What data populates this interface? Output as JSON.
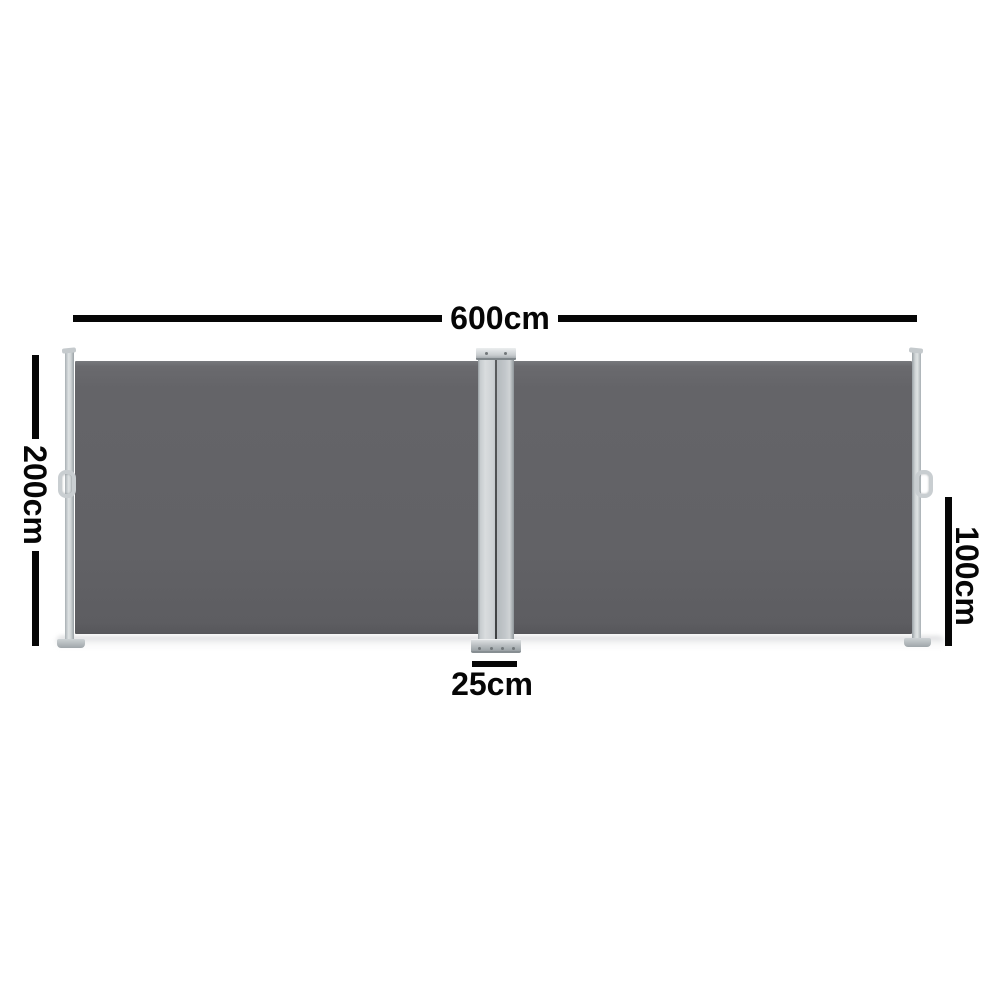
{
  "diagram": {
    "labels": {
      "width": "600cm",
      "height_left": "200cm",
      "height_right": "100cm",
      "base_width": "25cm"
    },
    "colors": {
      "background": "#ffffff",
      "fabric": "#636367",
      "frame_light": "#dfe3e4",
      "frame_mid": "#b7bcc0",
      "frame_dark": "#8f969a",
      "dimension_line": "#060606"
    }
  }
}
